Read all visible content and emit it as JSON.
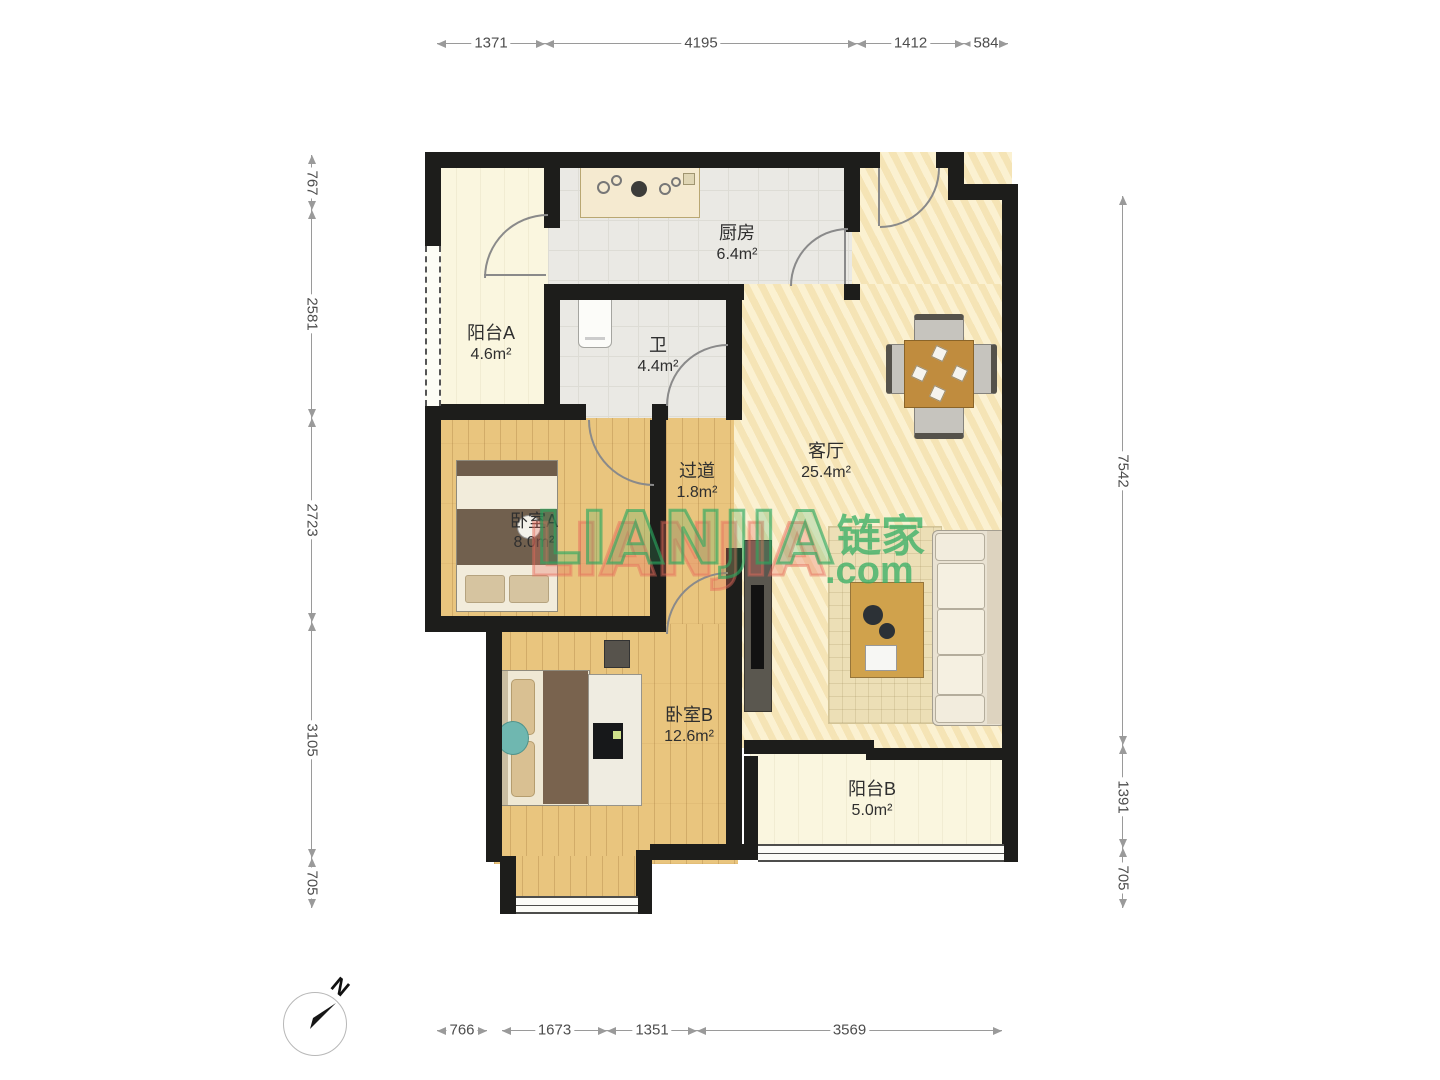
{
  "rooms": {
    "balcony_a": {
      "name": "阳台A",
      "area": "4.6m²"
    },
    "kitchen": {
      "name": "厨房",
      "area": "6.4m²"
    },
    "bath": {
      "name": "卫",
      "area": "4.4m²"
    },
    "hallway": {
      "name": "过道",
      "area": "1.8m²"
    },
    "living": {
      "name": "客厅",
      "area": "25.4m²"
    },
    "bedroom_a": {
      "name": "卧室A",
      "area": "8.0m²"
    },
    "bedroom_b": {
      "name": "卧室B",
      "area": "12.6m²"
    },
    "balcony_b": {
      "name": "阳台B",
      "area": "5.0m²"
    }
  },
  "dimensions_mm": {
    "top": [
      "1371",
      "4195",
      "1412",
      "584"
    ],
    "left": [
      "767",
      "2581",
      "2723",
      "3105",
      "705"
    ],
    "right": [
      "7542",
      "1391",
      "705"
    ],
    "bottom": [
      "766",
      "1673",
      "1351",
      "3569"
    ]
  },
  "compass": {
    "north": "N"
  },
  "watermark": {
    "latin": "LIANJIA",
    "cn": "链家",
    "com": ".com"
  },
  "colors": {
    "wall": "#1d1d1b",
    "wood_floor": "#e9c57e",
    "living_floor": "#f7e8bd",
    "tile_floor": "#eae9e4",
    "balcony_floor": "#faf6df",
    "watermark_green": "#33ae63",
    "watermark_red": "#e76a5c",
    "dimension_text": "#4d4d4d"
  }
}
